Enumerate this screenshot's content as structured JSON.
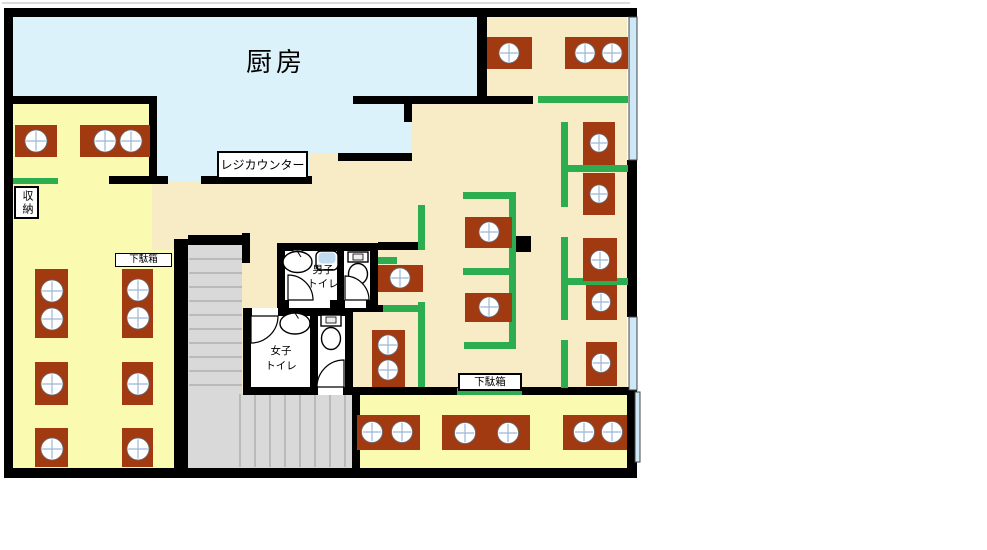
{
  "plan": {
    "labels": {
      "kitchen": "厨房",
      "register_counter": "レジカウンター",
      "storage": "収納",
      "shoe_cabinet_1": "下駄箱",
      "shoe_cabinet_2": "下駄箱",
      "mens_toilet": [
        "男子",
        "トイレ"
      ],
      "womens_toilet": [
        "女子",
        "トイレ"
      ]
    }
  },
  "colors": {
    "wall": "#000000",
    "floor_hall": "#F8ECC6",
    "floor_room": "#FAFAB0",
    "kitchen_floor": "#DCF2FB",
    "table": "#A13A10",
    "partition_green": "#2BAD50",
    "stairs": "#D9D9D9",
    "stair_tread": "#B0B0B0",
    "window": "#CFE8F8",
    "seat_mark": "#9DB8D8",
    "fixture_blue": "#BFDCF0"
  },
  "furniture": {
    "tables": [
      {
        "x": 15,
        "y": 125,
        "w": 42,
        "h": 32,
        "r": 11,
        "seats": [
          [
            36,
            141
          ]
        ]
      },
      {
        "x": 80,
        "y": 125,
        "w": 70,
        "h": 32,
        "r": 11,
        "seats": [
          [
            105,
            141
          ],
          [
            131,
            141
          ]
        ]
      },
      {
        "x": 35,
        "y": 269,
        "w": 33,
        "h": 69,
        "r": 11,
        "seats": [
          [
            52,
            291
          ],
          [
            52,
            319
          ]
        ]
      },
      {
        "x": 122,
        "y": 269,
        "w": 31,
        "h": 69,
        "r": 11,
        "seats": [
          [
            138,
            290
          ],
          [
            138,
            318
          ]
        ]
      },
      {
        "x": 35,
        "y": 362,
        "w": 33,
        "h": 43,
        "r": 11,
        "seats": [
          [
            52,
            384
          ]
        ]
      },
      {
        "x": 122,
        "y": 362,
        "w": 31,
        "h": 43,
        "r": 11,
        "seats": [
          [
            138,
            384
          ]
        ]
      },
      {
        "x": 35,
        "y": 428,
        "w": 33,
        "h": 39,
        "r": 11,
        "seats": [
          [
            52,
            449
          ]
        ]
      },
      {
        "x": 122,
        "y": 428,
        "w": 31,
        "h": 39,
        "r": 11,
        "seats": [
          [
            138,
            449
          ]
        ]
      },
      {
        "x": 487,
        "y": 37,
        "w": 45,
        "h": 32,
        "r": 10,
        "seats": [
          [
            509,
            53
          ]
        ]
      },
      {
        "x": 565,
        "y": 37,
        "w": 63,
        "h": 32,
        "r": 10,
        "seats": [
          [
            585,
            53
          ],
          [
            612,
            53
          ]
        ]
      },
      {
        "x": 583,
        "y": 122,
        "w": 32,
        "h": 43,
        "r": 9,
        "seats": [
          [
            599,
            143
          ]
        ]
      },
      {
        "x": 583,
        "y": 173,
        "w": 32,
        "h": 42,
        "r": 9,
        "seats": [
          [
            599,
            194
          ]
        ]
      },
      {
        "x": 583,
        "y": 238,
        "w": 34,
        "h": 43,
        "r": 9.5,
        "seats": [
          [
            600,
            260
          ]
        ]
      },
      {
        "x": 586,
        "y": 285,
        "w": 31,
        "h": 35,
        "r": 9.5,
        "seats": [
          [
            601,
            302
          ]
        ]
      },
      {
        "x": 586,
        "y": 342,
        "w": 31,
        "h": 44,
        "r": 9.5,
        "seats": [
          [
            601,
            363
          ]
        ]
      },
      {
        "x": 465,
        "y": 217,
        "w": 47,
        "h": 31,
        "r": 10,
        "seats": [
          [
            489,
            232
          ]
        ]
      },
      {
        "x": 465,
        "y": 293,
        "w": 47,
        "h": 29,
        "r": 10,
        "seats": [
          [
            489,
            307
          ]
        ]
      },
      {
        "x": 378,
        "y": 265,
        "w": 45,
        "h": 27,
        "r": 10,
        "seats": [
          [
            400,
            278
          ]
        ]
      },
      {
        "x": 372,
        "y": 330,
        "w": 33,
        "h": 57,
        "r": 10,
        "seats": [
          [
            388,
            345
          ],
          [
            388,
            370
          ]
        ]
      },
      {
        "x": 357,
        "y": 415,
        "w": 63,
        "h": 35,
        "r": 10.5,
        "seats": [
          [
            372,
            432
          ],
          [
            402,
            432
          ]
        ]
      },
      {
        "x": 442,
        "y": 415,
        "w": 88,
        "h": 35,
        "r": 10.5,
        "seats": [
          [
            465,
            433
          ],
          [
            508,
            433
          ]
        ]
      },
      {
        "x": 563,
        "y": 415,
        "w": 64,
        "h": 35,
        "r": 10.5,
        "seats": [
          [
            584,
            432
          ],
          [
            612,
            432
          ]
        ]
      }
    ],
    "partitions": [
      [
        13,
        178,
        45,
        6
      ],
      [
        538,
        96,
        90,
        7
      ],
      [
        561,
        122,
        7,
        85
      ],
      [
        568,
        165,
        60,
        7
      ],
      [
        561,
        237,
        7,
        83
      ],
      [
        566,
        278,
        62,
        7
      ],
      [
        561,
        340,
        7,
        48
      ],
      [
        463,
        192,
        53,
        7
      ],
      [
        509,
        192,
        7,
        152
      ],
      [
        463,
        268,
        46,
        7
      ],
      [
        464,
        342,
        52,
        7
      ],
      [
        418,
        205,
        7,
        45
      ],
      [
        418,
        302,
        7,
        85
      ],
      [
        383,
        305,
        42,
        7
      ],
      [
        378,
        257,
        19,
        7
      ],
      [
        457,
        388,
        65,
        7
      ]
    ]
  }
}
